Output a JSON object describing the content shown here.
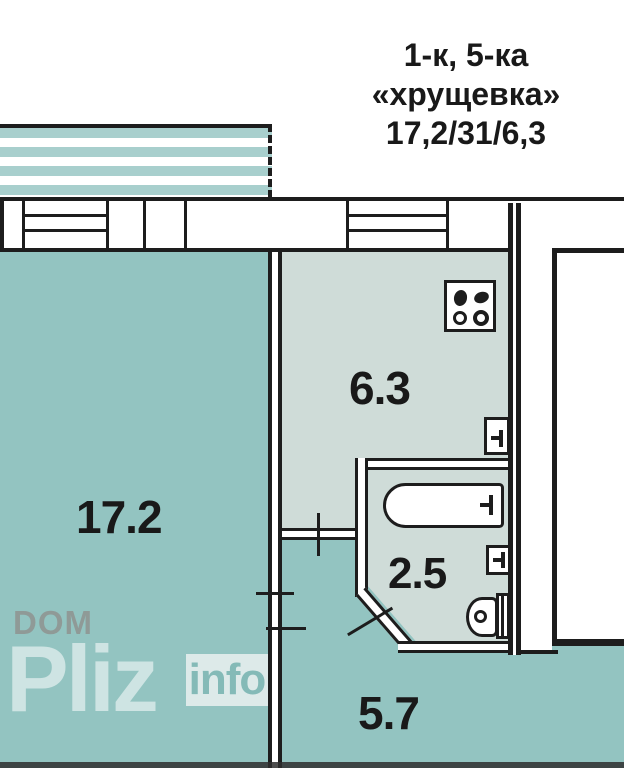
{
  "title": {
    "line1": "1-к, 5-ка",
    "line2": "«хрущевка»",
    "line3": "17,2/31/6,3"
  },
  "rooms": {
    "living": {
      "label": "17.2"
    },
    "kitchen": {
      "label": "6.3"
    },
    "bath": {
      "label": "2.5"
    },
    "hall": {
      "label": "5.7"
    }
  },
  "watermark": {
    "dom": "DOM",
    "pliz": "Pliz",
    "info": "info"
  },
  "icons": {
    "kitchen_stove": "stove-icon",
    "kitchen_sink": "sink-icon",
    "bathtub": "bathtub-icon",
    "washbasin": "washbasin-icon",
    "toilet": "toilet-icon"
  },
  "colors": {
    "wall": "#1d1d1d",
    "room_teal": "#93c4c1",
    "room_light": "#cfdcd8",
    "balcony_stripe": "#a8cfcd",
    "watermark_gray": "#8f9a97",
    "watermark_info": "#84bab7",
    "text": "#191919"
  }
}
